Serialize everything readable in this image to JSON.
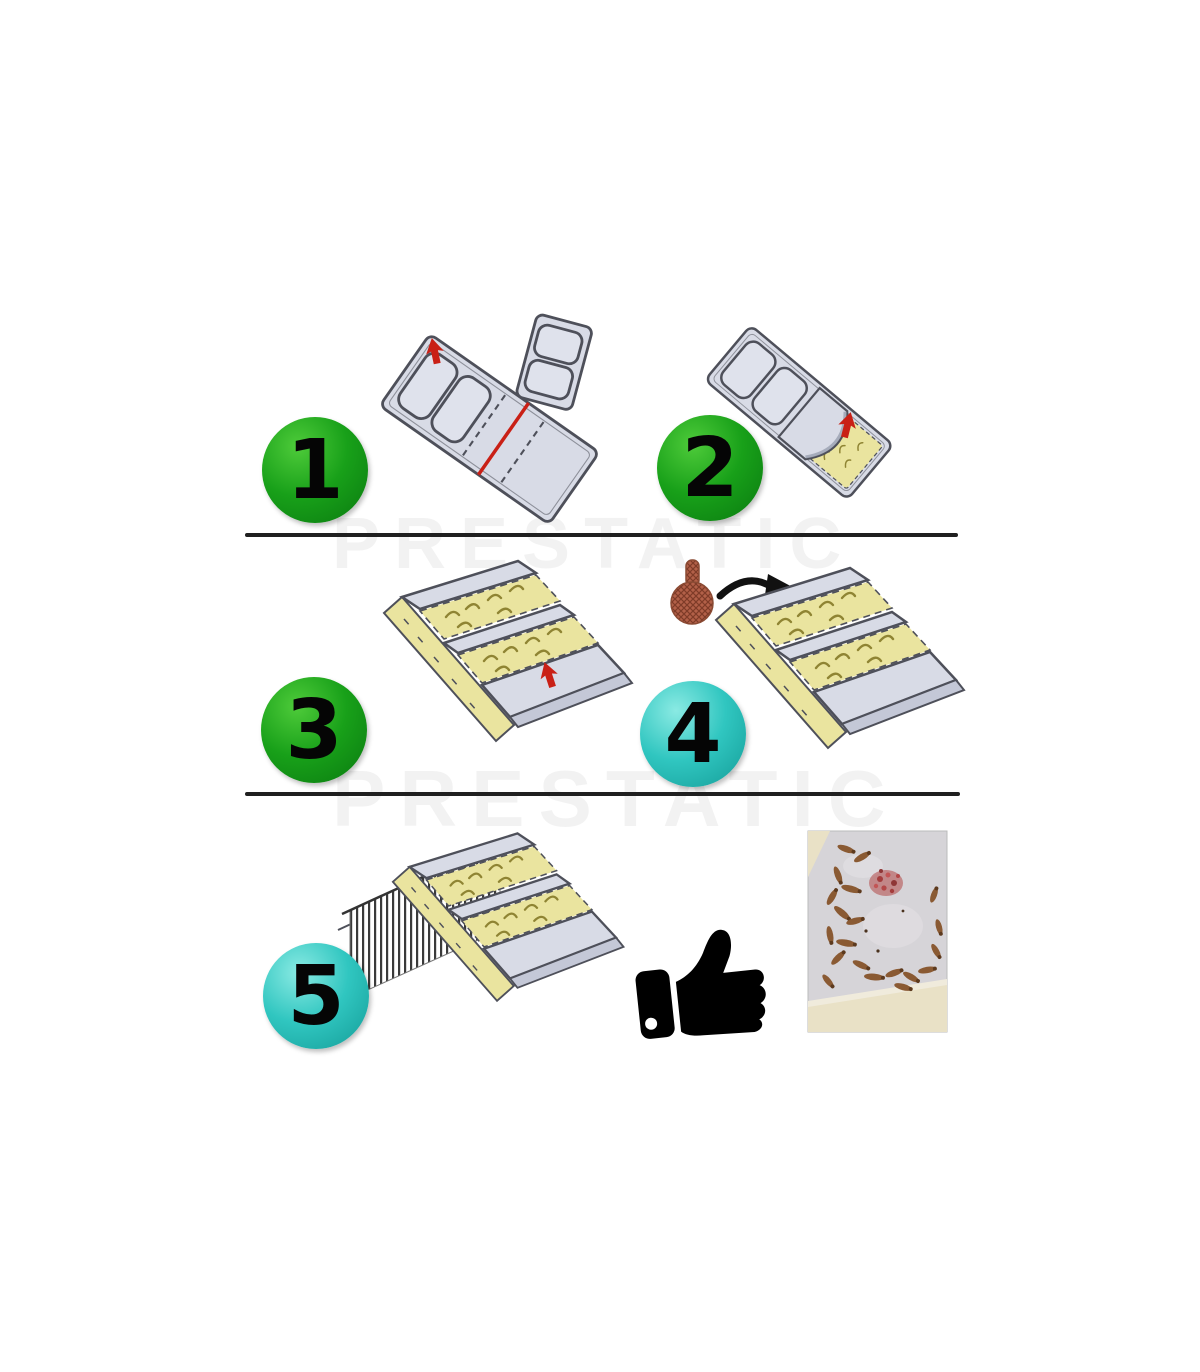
{
  "page": {
    "background": "#ffffff",
    "width": 1200,
    "height": 1372
  },
  "watermark": {
    "text": "PRESTATIC"
  },
  "steps": [
    {
      "number": "1",
      "badge": "green"
    },
    {
      "number": "2",
      "badge": "green"
    },
    {
      "number": "3",
      "badge": "green"
    },
    {
      "number": "4",
      "badge": "cyan"
    },
    {
      "number": "5",
      "badge": "cyan"
    }
  ],
  "icons": {
    "thumbs_up": "thumbs-up-icon",
    "bait_capsule": "bait-capsule-icon",
    "red_arrow": "red-arrow-icon",
    "curved_arrow": "curved-black-arrow-icon"
  },
  "colors": {
    "badge_green": "#18a019",
    "badge_green_hi": "#4ecb3a",
    "badge_green_dark": "#0a7a10",
    "badge_cyan": "#30c6c0",
    "badge_cyan_hi": "#8aeae3",
    "badge_cyan_dark": "#149c97",
    "board": "#d8dbe6",
    "board_shade": "#c4c8d7",
    "board_light": "#dfe2ec",
    "outline": "#4e505a",
    "glue": "#eae49f",
    "glue_mark": "#8f8433",
    "red_accent": "#c92016",
    "bait": "#b26048",
    "bait_dark": "#7e3b28",
    "divider": "#202020",
    "watermark": "rgba(0,0,0,0.05)",
    "wall_hatch": "#3a3a3a",
    "thumb": "#000000",
    "photo_surface": "#d6d4d8",
    "photo_tray": "#e9e1c6",
    "photo_bug": "#8a5a33",
    "photo_bait": "#b34747"
  }
}
